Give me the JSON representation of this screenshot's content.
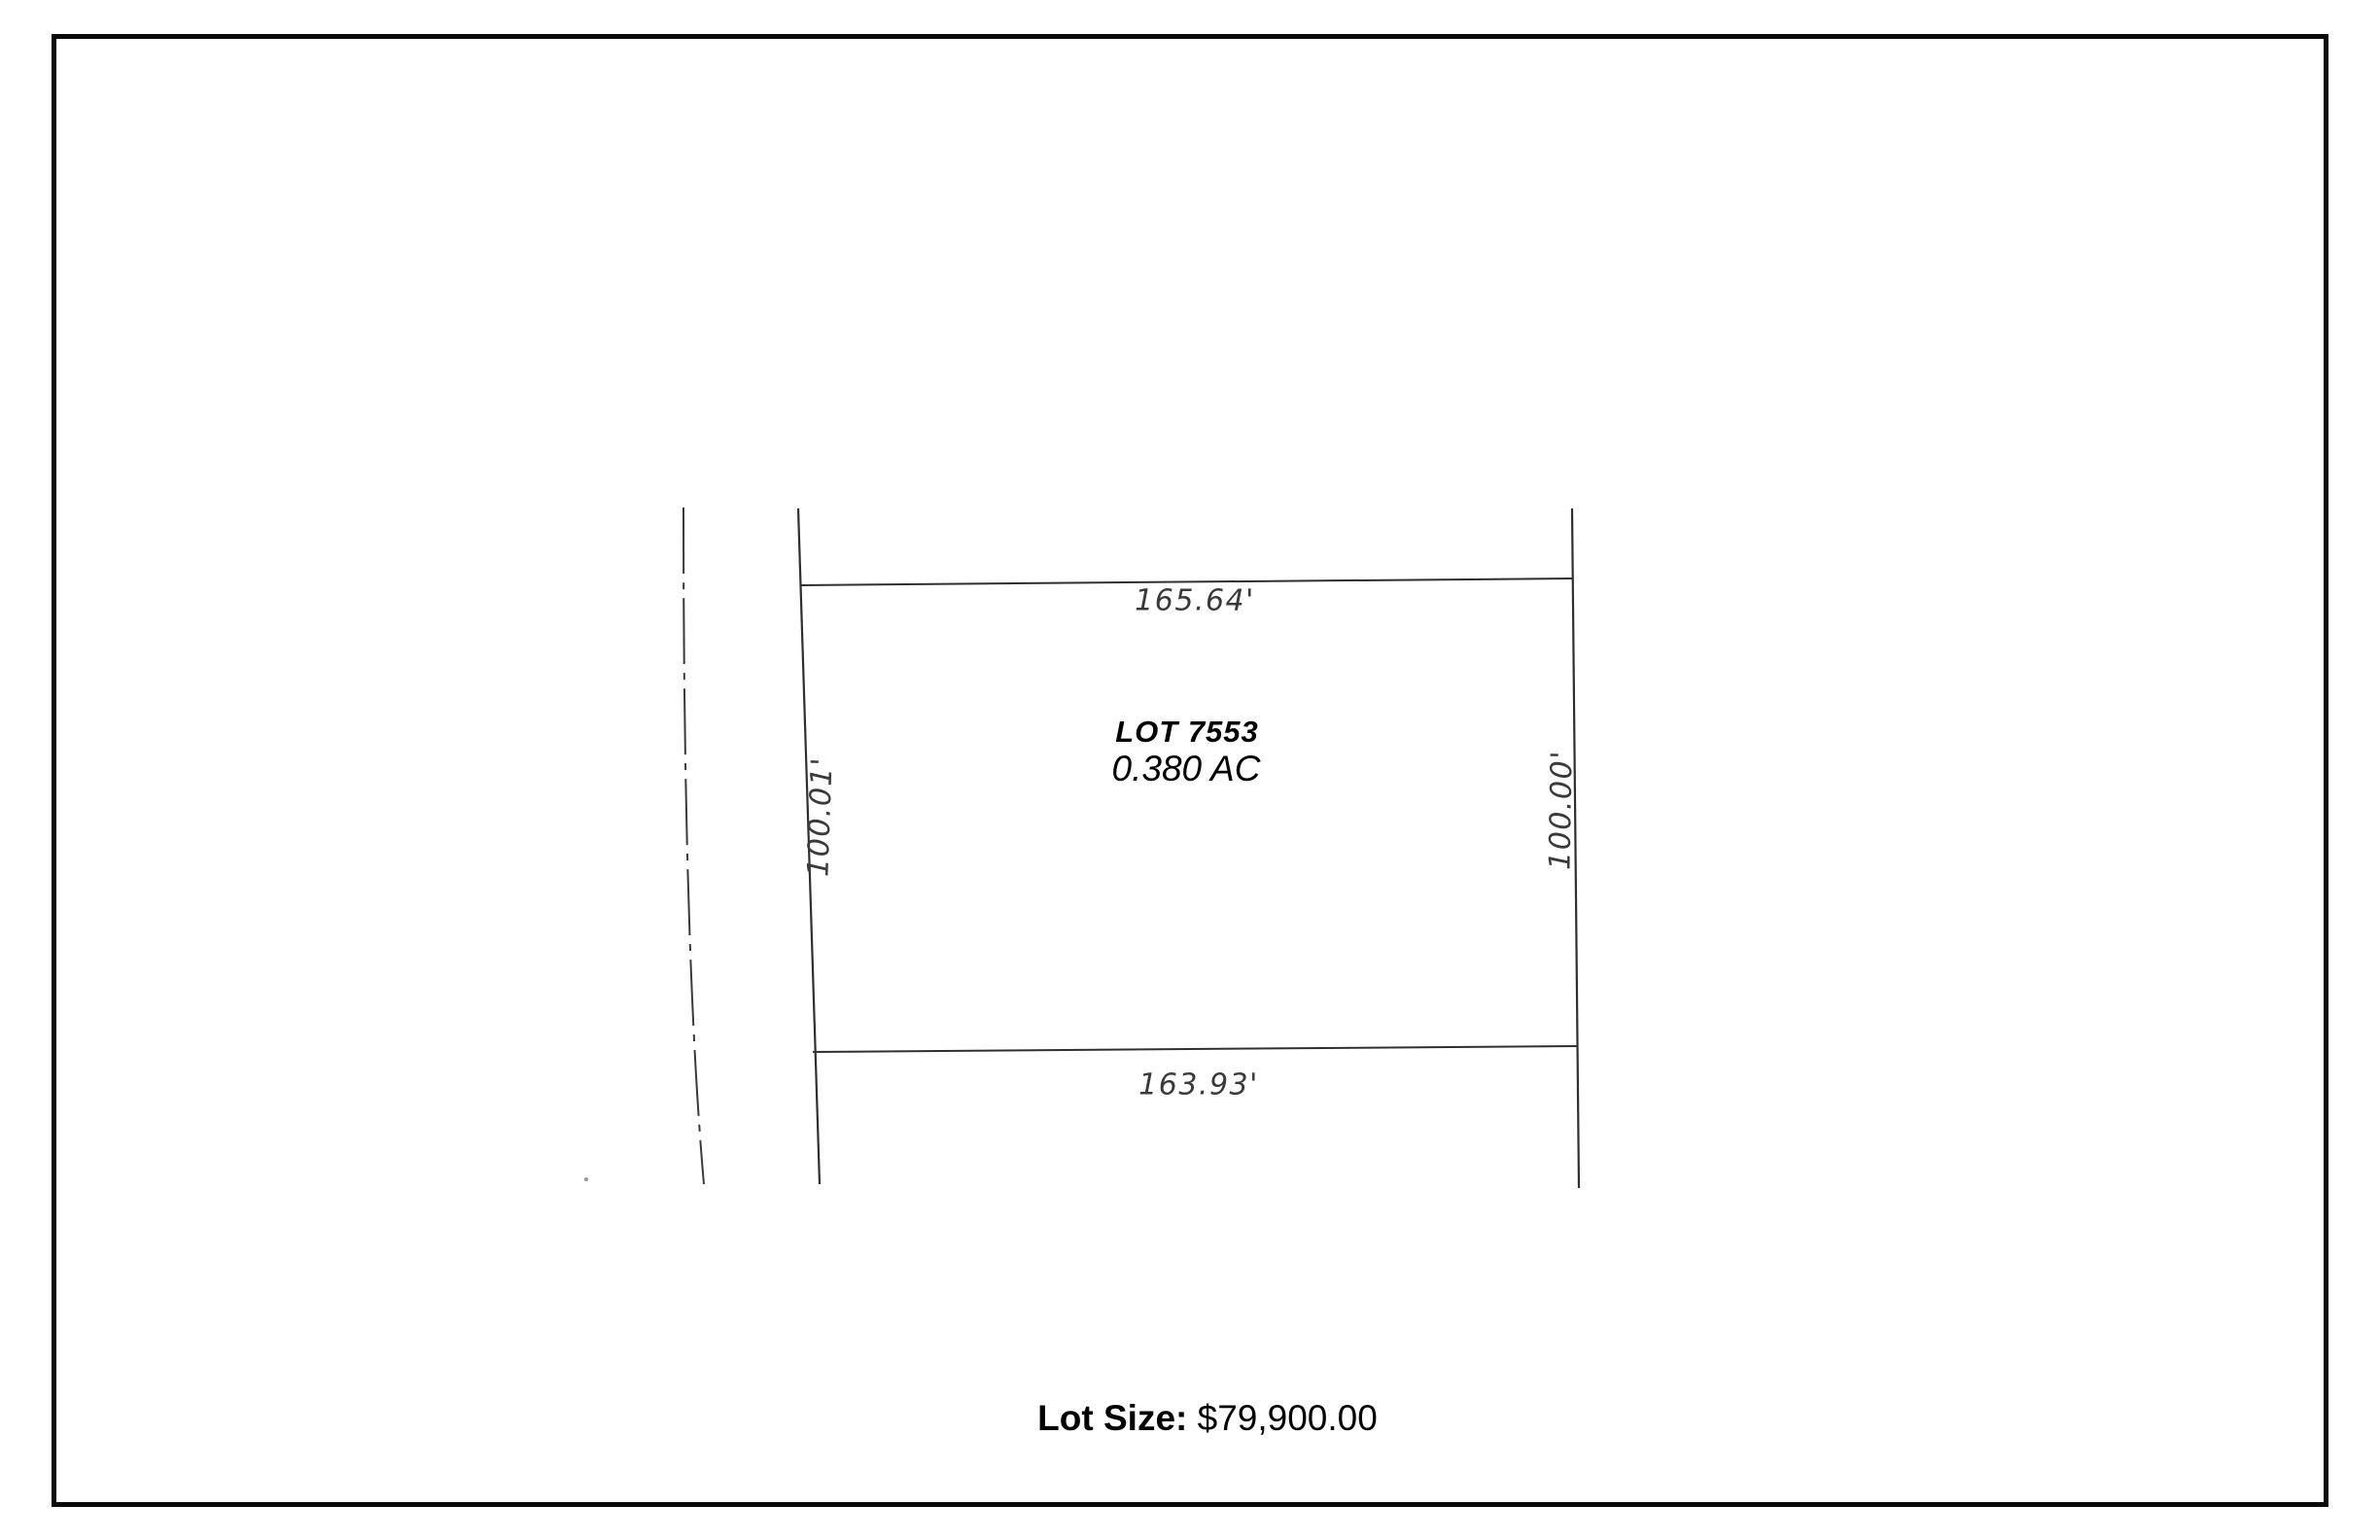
{
  "page": {
    "background": "#ffffff",
    "border_color": "#0a0a0a"
  },
  "plat": {
    "lot_label": "LOT 7553",
    "lot_area": "0.380 AC",
    "dimensions": {
      "top": "165.64'",
      "bottom": "163.93'",
      "left": "100.01'",
      "right": "100.00'"
    },
    "line_color": "#333333"
  },
  "footer": {
    "label": "Lot Size:",
    "value": "$79,900.00"
  }
}
